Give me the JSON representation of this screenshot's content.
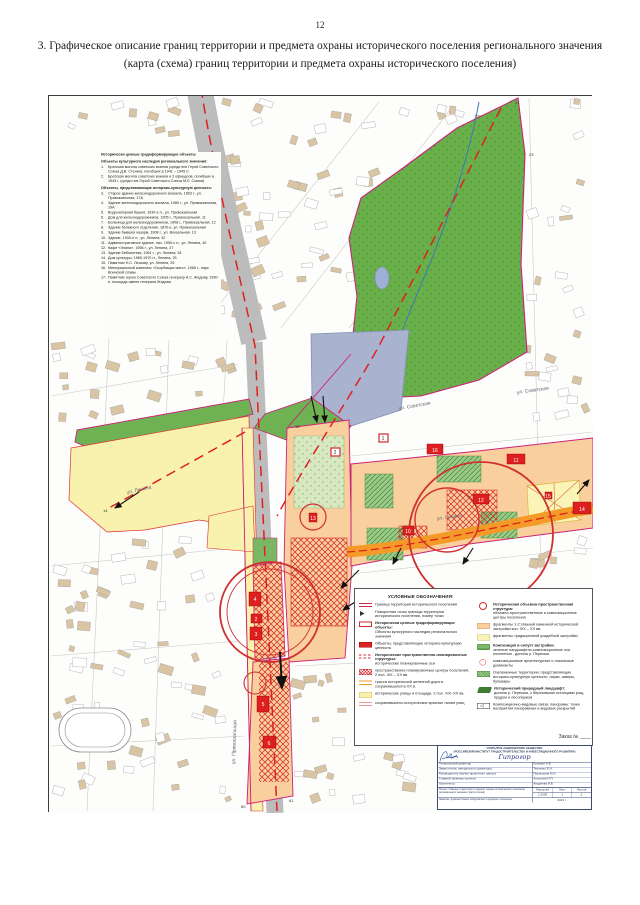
{
  "page": {
    "number": "12",
    "title_line1": "3. Графическое описание границ территории и предмета охраны исторического поселения регионального значения",
    "title_line2": "(карта (схема) границ территории и предмета охраны исторического поселения)"
  },
  "colors": {
    "boundary": "#cc2277",
    "axis": "#e02020",
    "park_green": "#69b04b",
    "pond": "#a9b2cf",
    "rail_trace_orange": "#f49a28",
    "built_peach": "#f9cf9e",
    "street_yellow": "#f8f2ae",
    "object_red": "#dd1f1f",
    "railway_gray": "#bcbcbc"
  },
  "objects_list": {
    "title": "Исторически ценные градоформирующие объекты",
    "group1_header": "Объекты культурного наследия регионального значения:",
    "group1": [
      {
        "num": "1.",
        "text": "Братская могила советских воинов (среди них Герой Советского Союза Д.В. Стенин), погибших в 1941 – 1945 гг."
      },
      {
        "num": "2.",
        "text": "Братская могила советских воинов и 3 офицеров, погибших в 1943 г. (среди них Герой Советского Союза М.Л. Сомов)"
      }
    ],
    "group2_header": "Объекты, представляющие историко-культурную ценность:",
    "group2": [
      {
        "num": "3.",
        "text": "Старое здание железнодорожного вокзала, 1893 г., ул. Привокзальная, 17А"
      },
      {
        "num": "4.",
        "text": "Здание железнодорожного вокзала, 1980 г., ул. Привокзальная, 19А"
      },
      {
        "num": "5.",
        "text": "Водонапорная башня, 1930-е гг., ул. Привокзальная"
      },
      {
        "num": "6.",
        "text": "Дом для железнодорожников, 1905 г., Привокзальная, 11"
      },
      {
        "num": "7.",
        "text": "Больница для железнодорожников, 1908 г., Привокзальная, 12"
      },
      {
        "num": "8.",
        "text": "Здание багажного отделения, 1870-е, ул. Привокзальная"
      },
      {
        "num": "9.",
        "text": "Здание бывших казарм, 1908 г., ул. Вокзальная, 13"
      },
      {
        "num": "10.",
        "text": "Здание, 1930-е гг., ул. Ленина, 42"
      },
      {
        "num": "11.",
        "text": "Административное здание, нач. 1950-х гг., ул. Ленина, 40"
      },
      {
        "num": "12.",
        "text": "Кафе «Элина», 1956 г., ул. Ленина, 37"
      },
      {
        "num": "13.",
        "text": "Здание библиотеки, 1961 г., ул. Ленина, 34"
      },
      {
        "num": "14.",
        "text": "Дом культуры, 1969-1970 гг., Ленина, 25"
      },
      {
        "num": "15.",
        "text": "Памятник Н.С. Лескову, ул. Ленина, 25"
      },
      {
        "num": "16.",
        "text": "Мемориальный комплекс «Скорбящая мать», 1965 г., парк Воинской славы"
      },
      {
        "num": "17.",
        "text": "Памятник герою Советского Союза генералу А.С. Жадову, 1950-е, площадь имени генерала Жадова"
      }
    ]
  },
  "legend": {
    "title": "УСЛОВНЫЕ ОБОЗНАЧЕНИЯ:",
    "left": [
      {
        "sym": "border",
        "text": "Граница территории исторического поселения"
      },
      {
        "sym": "point",
        "text": "Поворотная точка границы территории исторического поселения, номер точки"
      },
      {
        "sym": "objreg",
        "head": "Исторически ценные градоформирующие объекты:",
        "text": "Объекты культурного наследия регионального значения"
      },
      {
        "sym": "objval",
        "text": "Объекты, представляющие историко-культурную ценность"
      },
      {
        "sym": "axis",
        "head": "Исторические пространственно-планировочные структуры:",
        "text": "исторические планировочные оси"
      },
      {
        "sym": "center",
        "text": "пространственно-планировочные центры поселения, 2 пол. XIX – XX вв."
      },
      {
        "sym": "rail",
        "text": "трасса исторической железной дороги, сохранившаяся в XX в."
      },
      {
        "sym": "street",
        "text": "исторические улицы и площади, 2 пол. XIX–XX вв."
      },
      {
        "sym": "redline",
        "text": "сохранившиеся исторические красные линии улиц"
      }
    ],
    "right": [
      {
        "sym": "dominant",
        "head": "Историческая объемно-пространственная структура:",
        "text": "объемно-пространственные и композиционные центры поселения"
      },
      {
        "sym": "stone",
        "text": "фрагменты 1-2 этажной каменной исторической застройки кон. XIX – XX вв."
      },
      {
        "sym": "estate",
        "text": "фрагменты традиционной усадебной застройки"
      },
      {
        "sym": "greenaxis",
        "head": "Композиция и силуэт застройки:",
        "text": "зеленые ландшафтно-композиционные оси поселения - долина р. Перекши"
      },
      {
        "sym": "dominant2",
        "text": "композиционные архитектурные и локальные доминанты"
      },
      {
        "sym": "greenterr",
        "text": "Озелененные территории, представляющие историко-культурную ценность: парки, скверы, бульвары"
      },
      {
        "sym": "landscape",
        "head": "Исторический природный ландшафт:",
        "text": "долина р. Перекши, с березовыми останцами рощ, прудом и лесопарком"
      },
      {
        "sym": "view",
        "text": "Композиционно-видовые связи, панорамы: точки восприятия панорамных и видовых раскрытий"
      }
    ]
  },
  "streets": [
    "ул. Ленина",
    "ул. Ленина",
    "ул. Советская",
    "ул. Привокзальная",
    "ул. Комсомольская",
    "ул. Советская"
  ],
  "marker_labels": [
    "4",
    "2",
    "3",
    "5",
    "6",
    "16",
    "11",
    "12",
    "13",
    "14",
    "15",
    "10",
    "1",
    "2"
  ],
  "vertices": [
    "21",
    "23",
    "15",
    "14",
    "60",
    "61"
  ],
  "stamp": {
    "order_label": "Заказ № ____",
    "org1": "ОТКРЫТОЕ АКЦИОНЕРНОЕ ОБЩЕСТВО",
    "org2": "«РОССИЙСКИЙ ИНСТИТУТ ГРАДОСТРОИТЕЛЬСТВА И ИНВЕСТИЦИОННОГО РАЗВИТИЯ»",
    "logo": "Гипрогор",
    "rows": [
      {
        "label": "Генеральный директор",
        "value": "Кузьмин А.В."
      },
      {
        "label": "Заместитель генерального директора",
        "value": "Ткаченко Е.Н."
      },
      {
        "label": "Руководитель научно-проектного центра",
        "value": "Перекшина М.А."
      },
      {
        "label": "Главный инженер проекта",
        "value": "Алексеев Н.П."
      },
      {
        "label": "Архитектор",
        "value": "Андреева И.В."
      }
    ],
    "project": "Проект: Границы территории и предмет охраны исторического поселения регионального значения. Карта (схема)",
    "scale_label": "Масштаб",
    "scale": "1:2000",
    "sheet_label": "Лист",
    "sheet": "1",
    "sheets_label": "Листов",
    "sheets": "2",
    "customer": "Заказчик: Администрация Сабуровского городского поселения",
    "year": "2021 г."
  }
}
